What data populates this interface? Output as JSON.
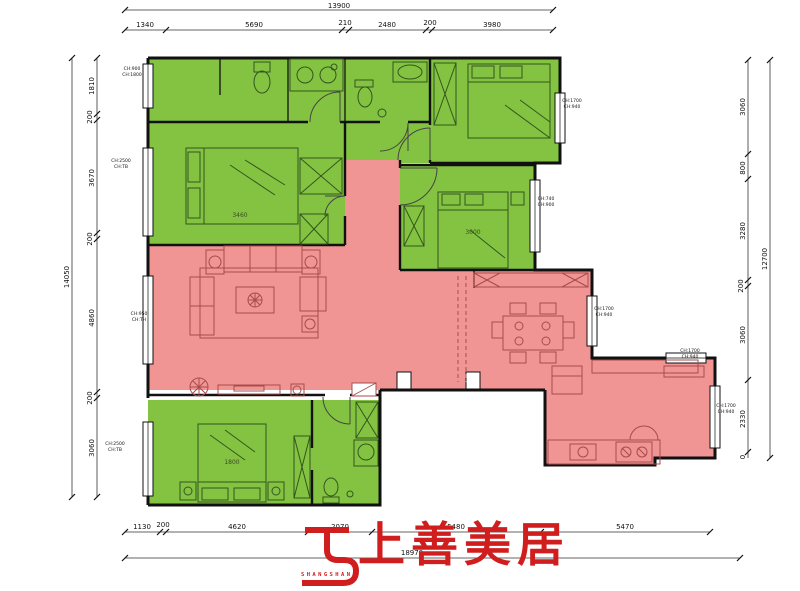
{
  "colors": {
    "room_green": "#84c341",
    "room_red": "#f19494",
    "wall": "#111111",
    "logo_red": "#d01e1e"
  },
  "dimensions": {
    "top_total": "13900",
    "top_segments": [
      "1340",
      "5690",
      "210",
      "2480",
      "200",
      "3980"
    ],
    "left_total": "14050",
    "left_segments": [
      "1810",
      "200",
      "3670",
      "200",
      "4860",
      "200",
      "3060"
    ],
    "right_total": "12700",
    "right_segments": [
      "3060",
      "800",
      "3280",
      "200",
      "3060",
      "2330",
      "0"
    ],
    "bottom_total": "18970",
    "bottom_segments": [
      "1130",
      "200",
      "4620",
      "2070",
      "5480",
      "5470"
    ]
  },
  "plan_labels": {
    "bed_left": "3460",
    "bed_mid": "3000",
    "bed_bottom": "1800"
  },
  "window_labels": [
    {
      "l1": "CH:900",
      "l2": "CH:1800"
    },
    {
      "l1": "CH:2500",
      "l2": "CH:TB"
    },
    {
      "l1": "CH:950",
      "l2": "CH:TH"
    },
    {
      "l1": "CH:2500",
      "l2": "CH:TB"
    },
    {
      "l1": "CH:1700",
      "l2": "CH:940"
    },
    {
      "l1": "CH:740",
      "l2": "CH:900"
    },
    {
      "l1": "CH:1700",
      "l2": "CH:940"
    },
    {
      "l1": "CH:1700",
      "l2": "CH:940"
    },
    {
      "l1": "CH:1700",
      "l2": "CH:940"
    }
  ],
  "logo": {
    "cn": "上善美居",
    "en1": "SHANGSHAN",
    "en2": "MEIJU"
  }
}
